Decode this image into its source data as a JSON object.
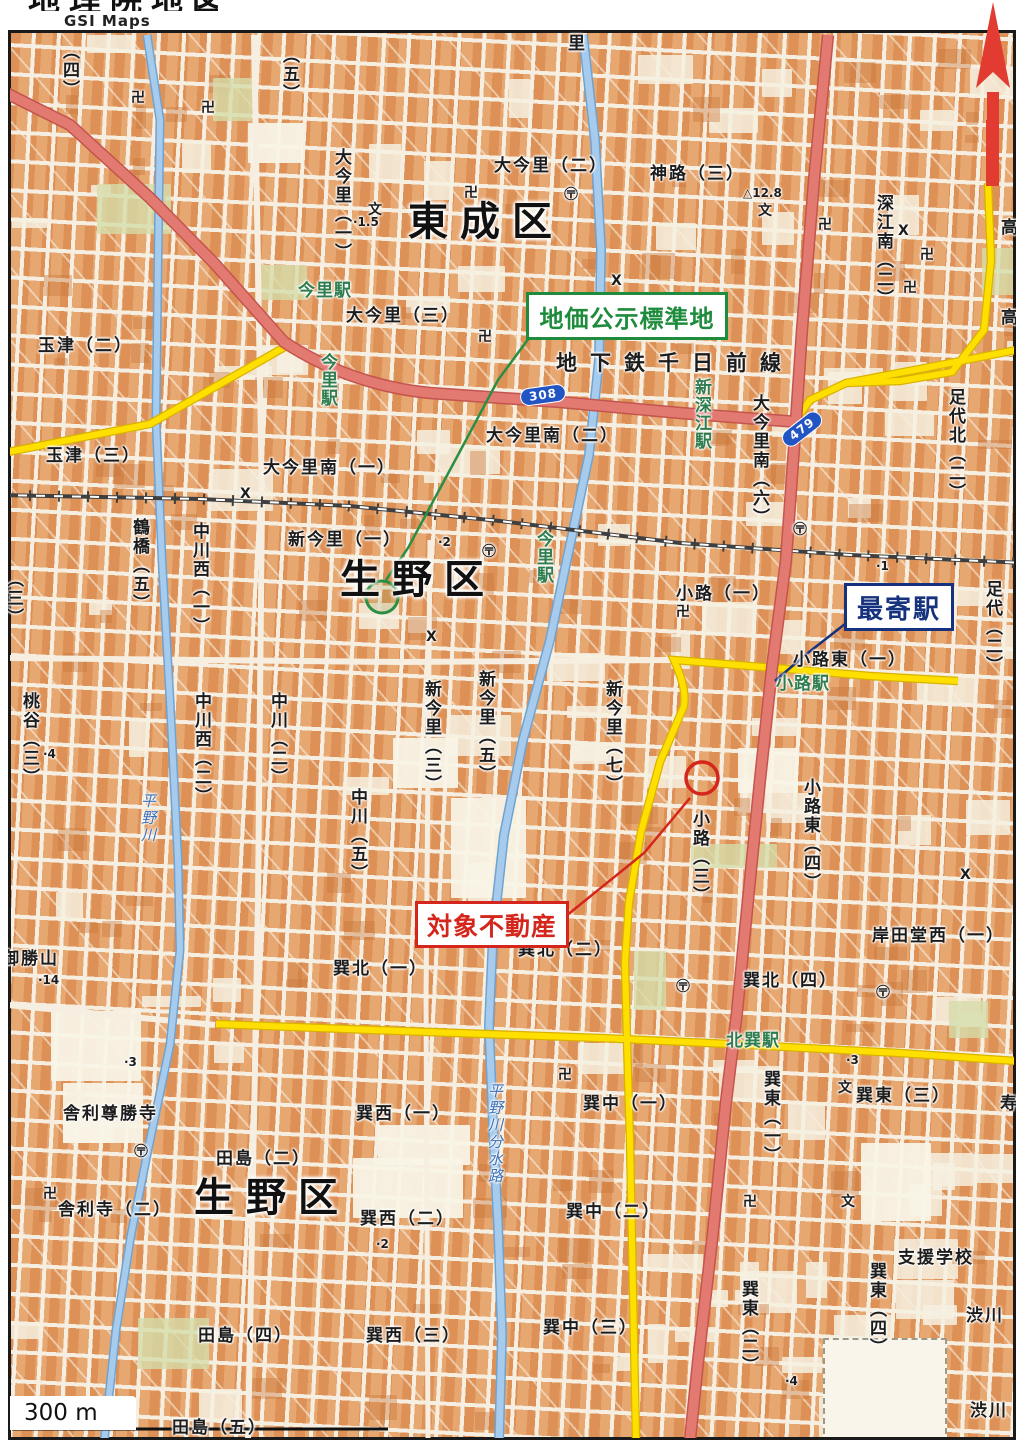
{
  "header": {
    "logo_text": "地理院地図",
    "logo_subtext": "GSI Maps"
  },
  "annotations": {
    "standard_land": {
      "label": "地価公示標準地",
      "color": "#1e8c3c"
    },
    "nearest_station": {
      "label": "最寄駅",
      "color": "#16327f"
    },
    "subject_property": {
      "label": "対象不動産",
      "color": "#d4261c"
    }
  },
  "scale_bar": {
    "label": "300 m"
  },
  "colors": {
    "block": "#e09a62",
    "street": "#f6efe1",
    "road_major_pink": "#e37a72",
    "road_secondary_yellow": "#ffdf00",
    "river_blue": "#a6cbec",
    "railway": "#3f3f3f",
    "station_green": "#2e7d4f",
    "annotation_green": "#1e8c3c",
    "annotation_blue": "#16327f",
    "annotation_red": "#d4261c"
  },
  "route_shields": [
    {
      "number": "308",
      "x": 520,
      "y": 386,
      "rot": -8
    },
    {
      "number": "479",
      "x": 779,
      "y": 420,
      "rot": -38
    }
  ],
  "map": {
    "labels": [
      {
        "t": "東成区",
        "x": 408,
        "y": 202,
        "c": "district"
      },
      {
        "t": "生野区",
        "x": 340,
        "y": 560,
        "c": "district"
      },
      {
        "t": "生野区",
        "x": 194,
        "y": 1178,
        "c": "district"
      },
      {
        "t": "地下鉄千日前線",
        "x": 556,
        "y": 353,
        "c": "subway"
      },
      {
        "t": "大今里（二）",
        "x": 494,
        "y": 158,
        "c": "area"
      },
      {
        "t": "神路（三）",
        "x": 650,
        "y": 166,
        "c": "area"
      },
      {
        "t": "玉津（二）",
        "x": 38,
        "y": 338,
        "c": "area"
      },
      {
        "t": "玉津（三）",
        "x": 46,
        "y": 448,
        "c": "area"
      },
      {
        "t": "大今里（三）",
        "x": 346,
        "y": 308,
        "c": "area"
      },
      {
        "t": "大今里南（二）",
        "x": 486,
        "y": 428,
        "c": "area"
      },
      {
        "t": "大今里南（一）",
        "x": 263,
        "y": 460,
        "c": "area"
      },
      {
        "t": "新今里（一）",
        "x": 288,
        "y": 532,
        "c": "area"
      },
      {
        "t": "小路（一）",
        "x": 676,
        "y": 586,
        "c": "area"
      },
      {
        "t": "小路東（一）",
        "x": 793,
        "y": 652,
        "c": "area"
      },
      {
        "t": "岸田堂西（一）",
        "x": 872,
        "y": 928,
        "c": "area"
      },
      {
        "t": "巽北（一）",
        "x": 333,
        "y": 961,
        "c": "area"
      },
      {
        "t": "巽北（二）",
        "x": 518,
        "y": 942,
        "c": "area"
      },
      {
        "t": "巽北（四）",
        "x": 743,
        "y": 973,
        "c": "area"
      },
      {
        "t": "巽西（一）",
        "x": 356,
        "y": 1106,
        "c": "area"
      },
      {
        "t": "巽西（二）",
        "x": 360,
        "y": 1211,
        "c": "area"
      },
      {
        "t": "巽西（三）",
        "x": 366,
        "y": 1328,
        "c": "area"
      },
      {
        "t": "巽中（一）",
        "x": 583,
        "y": 1096,
        "c": "area"
      },
      {
        "t": "巽中（二）",
        "x": 566,
        "y": 1204,
        "c": "area"
      },
      {
        "t": "巽中（三）",
        "x": 543,
        "y": 1320,
        "c": "area"
      },
      {
        "t": "巽東（三）",
        "x": 856,
        "y": 1088,
        "c": "area"
      },
      {
        "t": "支援学校",
        "x": 898,
        "y": 1250,
        "c": "area"
      },
      {
        "t": "渋川",
        "x": 966,
        "y": 1308,
        "c": "area"
      },
      {
        "t": "渋川",
        "x": 970,
        "y": 1403,
        "c": "area"
      },
      {
        "t": "田島（二）",
        "x": 216,
        "y": 1151,
        "c": "area"
      },
      {
        "t": "田島（四）",
        "x": 198,
        "y": 1328,
        "c": "area"
      },
      {
        "t": "田島（五）",
        "x": 172,
        "y": 1420,
        "c": "area"
      },
      {
        "t": "御勝山",
        "x": 2,
        "y": 951,
        "c": "area"
      },
      {
        "t": "舎利尊勝寺",
        "x": 63,
        "y": 1106,
        "c": "area"
      },
      {
        "t": "舎利寺（二）",
        "x": 58,
        "y": 1202,
        "c": "area"
      },
      {
        "t": "里",
        "x": 568,
        "y": 36,
        "c": "area"
      },
      {
        "t": "寿",
        "x": 1000,
        "y": 1096,
        "c": "area"
      },
      {
        "t": "大今里（一）",
        "x": 332,
        "y": 148,
        "c": "area",
        "v": true
      },
      {
        "t": "深江南（二）",
        "x": 874,
        "y": 194,
        "c": "area",
        "v": true
      },
      {
        "t": "大今里南（六）",
        "x": 750,
        "y": 394,
        "c": "area",
        "v": true
      },
      {
        "t": "足代北（二）",
        "x": 946,
        "y": 388,
        "c": "area",
        "v": true
      },
      {
        "t": "足代（二）",
        "x": 983,
        "y": 580,
        "c": "area",
        "v": true
      },
      {
        "t": "高",
        "x": 998,
        "y": 218,
        "c": "area",
        "v": true
      },
      {
        "t": "高",
        "x": 998,
        "y": 308,
        "c": "area",
        "v": true
      },
      {
        "t": "桃谷（三）",
        "x": 20,
        "y": 692,
        "c": "area",
        "v": true
      },
      {
        "t": "鶴橋（五）",
        "x": 130,
        "y": 518,
        "c": "area",
        "v": true
      },
      {
        "t": "中川西（一）",
        "x": 190,
        "y": 522,
        "c": "area",
        "v": true
      },
      {
        "t": "中川西（二）",
        "x": 192,
        "y": 692,
        "c": "area",
        "v": true
      },
      {
        "t": "中川（二）",
        "x": 268,
        "y": 692,
        "c": "area",
        "v": true
      },
      {
        "t": "中川（五）",
        "x": 348,
        "y": 788,
        "c": "area",
        "v": true
      },
      {
        "t": "新今里（三）",
        "x": 422,
        "y": 680,
        "c": "area",
        "v": true
      },
      {
        "t": "新今里（五）",
        "x": 476,
        "y": 670,
        "c": "area",
        "v": true
      },
      {
        "t": "新今里（七）",
        "x": 603,
        "y": 680,
        "c": "area",
        "v": true
      },
      {
        "t": "小路（三）",
        "x": 690,
        "y": 810,
        "c": "area",
        "v": true
      },
      {
        "t": "小路東（四）",
        "x": 801,
        "y": 778,
        "c": "area",
        "v": true
      },
      {
        "t": "巽東（一）",
        "x": 761,
        "y": 1070,
        "c": "area",
        "v": true
      },
      {
        "t": "巽東（二）",
        "x": 739,
        "y": 1280,
        "c": "area",
        "v": true
      },
      {
        "t": "巽東（四）",
        "x": 867,
        "y": 1262,
        "c": "area",
        "v": true
      },
      {
        "t": "（四）",
        "x": 60,
        "y": 42,
        "c": "area",
        "v": true
      },
      {
        "t": "（五）",
        "x": 280,
        "y": 46,
        "c": "area",
        "v": true
      },
      {
        "t": "（三）",
        "x": 4,
        "y": 570,
        "c": "area",
        "v": true
      },
      {
        "t": "今里駅",
        "x": 298,
        "y": 283,
        "c": "station"
      },
      {
        "t": "今里駅",
        "x": 318,
        "y": 353,
        "c": "station",
        "v": true
      },
      {
        "t": "今里駅",
        "x": 534,
        "y": 530,
        "c": "station",
        "v": true
      },
      {
        "t": "新深江駅",
        "x": 692,
        "y": 378,
        "c": "station",
        "v": true
      },
      {
        "t": "小路駅",
        "x": 776,
        "y": 676,
        "c": "station"
      },
      {
        "t": "北巽駅",
        "x": 726,
        "y": 1033,
        "c": "station"
      },
      {
        "t": "平野川",
        "x": 140,
        "y": 793,
        "c": "river",
        "v": true
      },
      {
        "t": "平野川分水路",
        "x": 487,
        "y": 1083,
        "c": "river",
        "v": true
      },
      {
        "t": "·1.5",
        "x": 353,
        "y": 216,
        "c": "spot"
      },
      {
        "t": "△12.8",
        "x": 743,
        "y": 187,
        "c": "spot"
      },
      {
        "t": "·2",
        "x": 438,
        "y": 536,
        "c": "spot"
      },
      {
        "t": "·1",
        "x": 876,
        "y": 560,
        "c": "spot"
      },
      {
        "t": "·2",
        "x": 376,
        "y": 1238,
        "c": "spot"
      },
      {
        "t": "·3",
        "x": 846,
        "y": 1054,
        "c": "spot"
      },
      {
        "t": "·3",
        "x": 124,
        "y": 1056,
        "c": "spot"
      },
      {
        "t": "·4",
        "x": 43,
        "y": 748,
        "c": "spot"
      },
      {
        "t": "·4",
        "x": 785,
        "y": 1375,
        "c": "spot"
      },
      {
        "t": "·14",
        "x": 38,
        "y": 974,
        "c": "spot"
      }
    ],
    "symbols": [
      {
        "t": "卍",
        "x": 464,
        "y": 186
      },
      {
        "t": "卍",
        "x": 818,
        "y": 218
      },
      {
        "t": "卍",
        "x": 920,
        "y": 248
      },
      {
        "t": "卍",
        "x": 903,
        "y": 281
      },
      {
        "t": "卍",
        "x": 478,
        "y": 330
      },
      {
        "t": "卍",
        "x": 676,
        "y": 605
      },
      {
        "t": "卍",
        "x": 526,
        "y": 907
      },
      {
        "t": "卍",
        "x": 558,
        "y": 1068
      },
      {
        "t": "卍",
        "x": 743,
        "y": 1195
      },
      {
        "t": "卍",
        "x": 43,
        "y": 1187
      },
      {
        "t": "卍",
        "x": 131,
        "y": 91
      },
      {
        "t": "卍",
        "x": 201,
        "y": 101
      },
      {
        "t": "文",
        "x": 368,
        "y": 203
      },
      {
        "t": "文",
        "x": 758,
        "y": 204
      },
      {
        "t": "文",
        "x": 838,
        "y": 1081
      },
      {
        "t": "文",
        "x": 841,
        "y": 1195
      },
      {
        "t": "〶",
        "x": 564,
        "y": 188
      },
      {
        "t": "〶",
        "x": 482,
        "y": 545
      },
      {
        "t": "〶",
        "x": 676,
        "y": 980
      },
      {
        "t": "〶",
        "x": 793,
        "y": 523
      },
      {
        "t": "〶",
        "x": 134,
        "y": 1145
      },
      {
        "t": "〶",
        "x": 876,
        "y": 986
      },
      {
        "t": "X",
        "x": 240,
        "y": 487
      },
      {
        "t": "X",
        "x": 898,
        "y": 224
      },
      {
        "t": "X",
        "x": 611,
        "y": 274
      },
      {
        "t": "X",
        "x": 960,
        "y": 868
      },
      {
        "t": "X",
        "x": 426,
        "y": 630
      }
    ]
  }
}
